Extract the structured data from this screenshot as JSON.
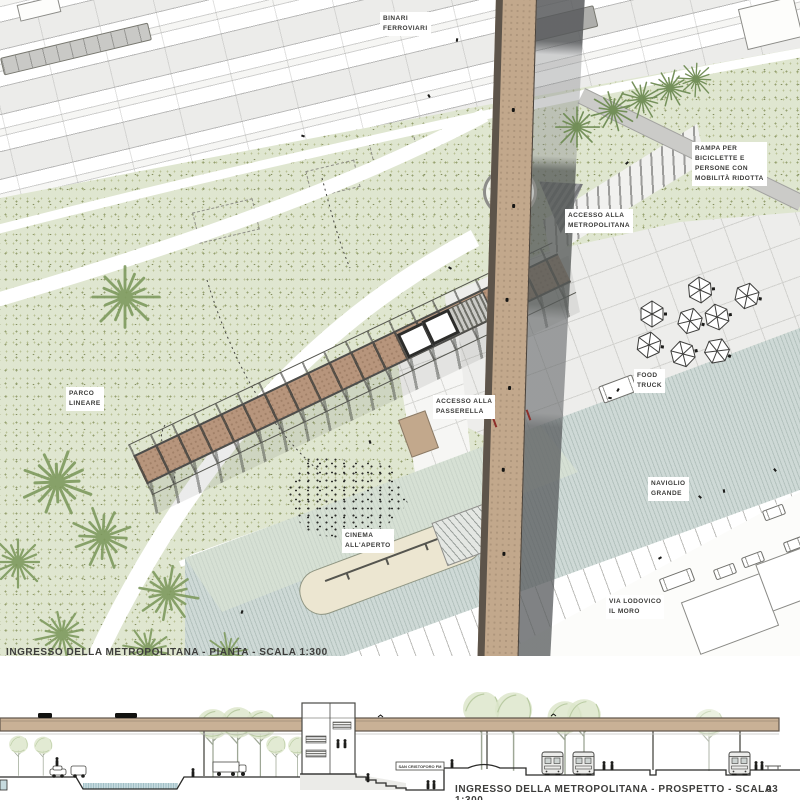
{
  "palette": {
    "park_green": "#dfe6d0",
    "stipple_olive": "#94a06f",
    "rail_gray": "#ececea",
    "plaza_gray": "#ededeb",
    "canal_blue_gray": "#ced9d6",
    "bridge_tan": "#c2a88c",
    "bridge_dark_brown": "#5d544a",
    "truss_brown": "#b7957c",
    "beam_dark": "#4c4d4b",
    "shadow_gray": "#63666a",
    "deck_tan": "#c9b196",
    "water_blue": "#c6dade",
    "tree_green": "#7e9a5e",
    "ink": "#3d3d3b"
  },
  "plan": {
    "title": "INGRESSO DELLA METROPOLITANA - PIANTA - SCALA 1:300",
    "labels": {
      "binari": "BINARI\nFERROVIARI",
      "rampa": "RAMPA PER\nBICICLETTE E\nPERSONE CON\nMOBILITÀ RIDOTTA",
      "accesso_metro": "ACCESSO ALLA\nMETROPOLITANA",
      "parco": "PARCO\nLINEARE",
      "accesso_passerella": "ACCESSO ALLA\nPASSERELLA",
      "food_truck": "FOOD\nTRUCK",
      "naviglio": "NAVIGLIO\nGRANDE",
      "cinema": "CINEMA\nALL'APERTO",
      "via": "VIA LODOVICO\nIL MORO"
    }
  },
  "elevation": {
    "title": "INGRESSO DELLA METROPOLITANA - PROSPETTO - SCALA 1:300",
    "sheet": "03",
    "sign": "SAN CRISTOFORO FM"
  }
}
